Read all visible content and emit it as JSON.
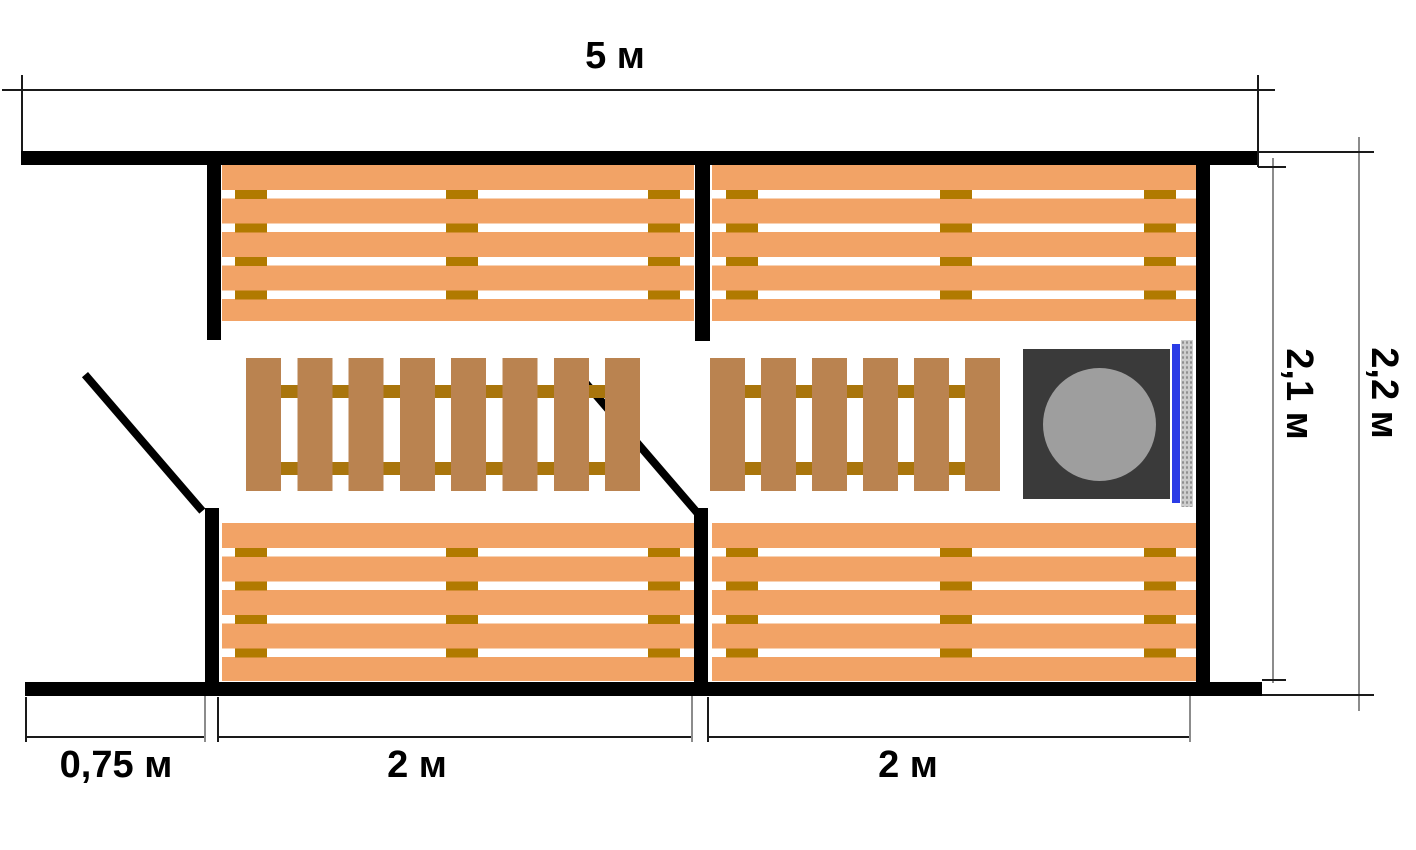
{
  "plan": {
    "kind": "sauna-floor-plan",
    "dimensions": {
      "width_total": "5 м",
      "height_inner": "2,1 м",
      "height_outer": "2,2 м",
      "entry_width": "0,75 м",
      "left_room_width": "2 м",
      "right_room_width": "2 м"
    },
    "objects": {
      "benches": [
        "bench-top-left",
        "bench-top-right",
        "bench-bottom-left",
        "bench-bottom-right"
      ],
      "duckboards": [
        "duckboard-left",
        "duckboard-right"
      ],
      "doors": [
        "entry-door-leaf",
        "steam-room-door-leaf"
      ],
      "stove": [
        "stove-body",
        "stove-round-lid",
        "stove-door-glass",
        "stove-heat-shield"
      ]
    },
    "colors": {
      "wall": "#000000",
      "bench_slat": "#f2a366",
      "bench_cleat": "#b17a00",
      "duckboard_slat": "#ba8350",
      "duckboard_rail": "#a9750c",
      "stove_body": "#3a3a3a",
      "stove_lid": "#9e9e9e",
      "stove_glass": "#2b3ce6",
      "stove_shield": "#cdcdcd",
      "dimension_line": "#1a1a1a",
      "dimension_tick_gray": "#8c8c8c"
    }
  }
}
